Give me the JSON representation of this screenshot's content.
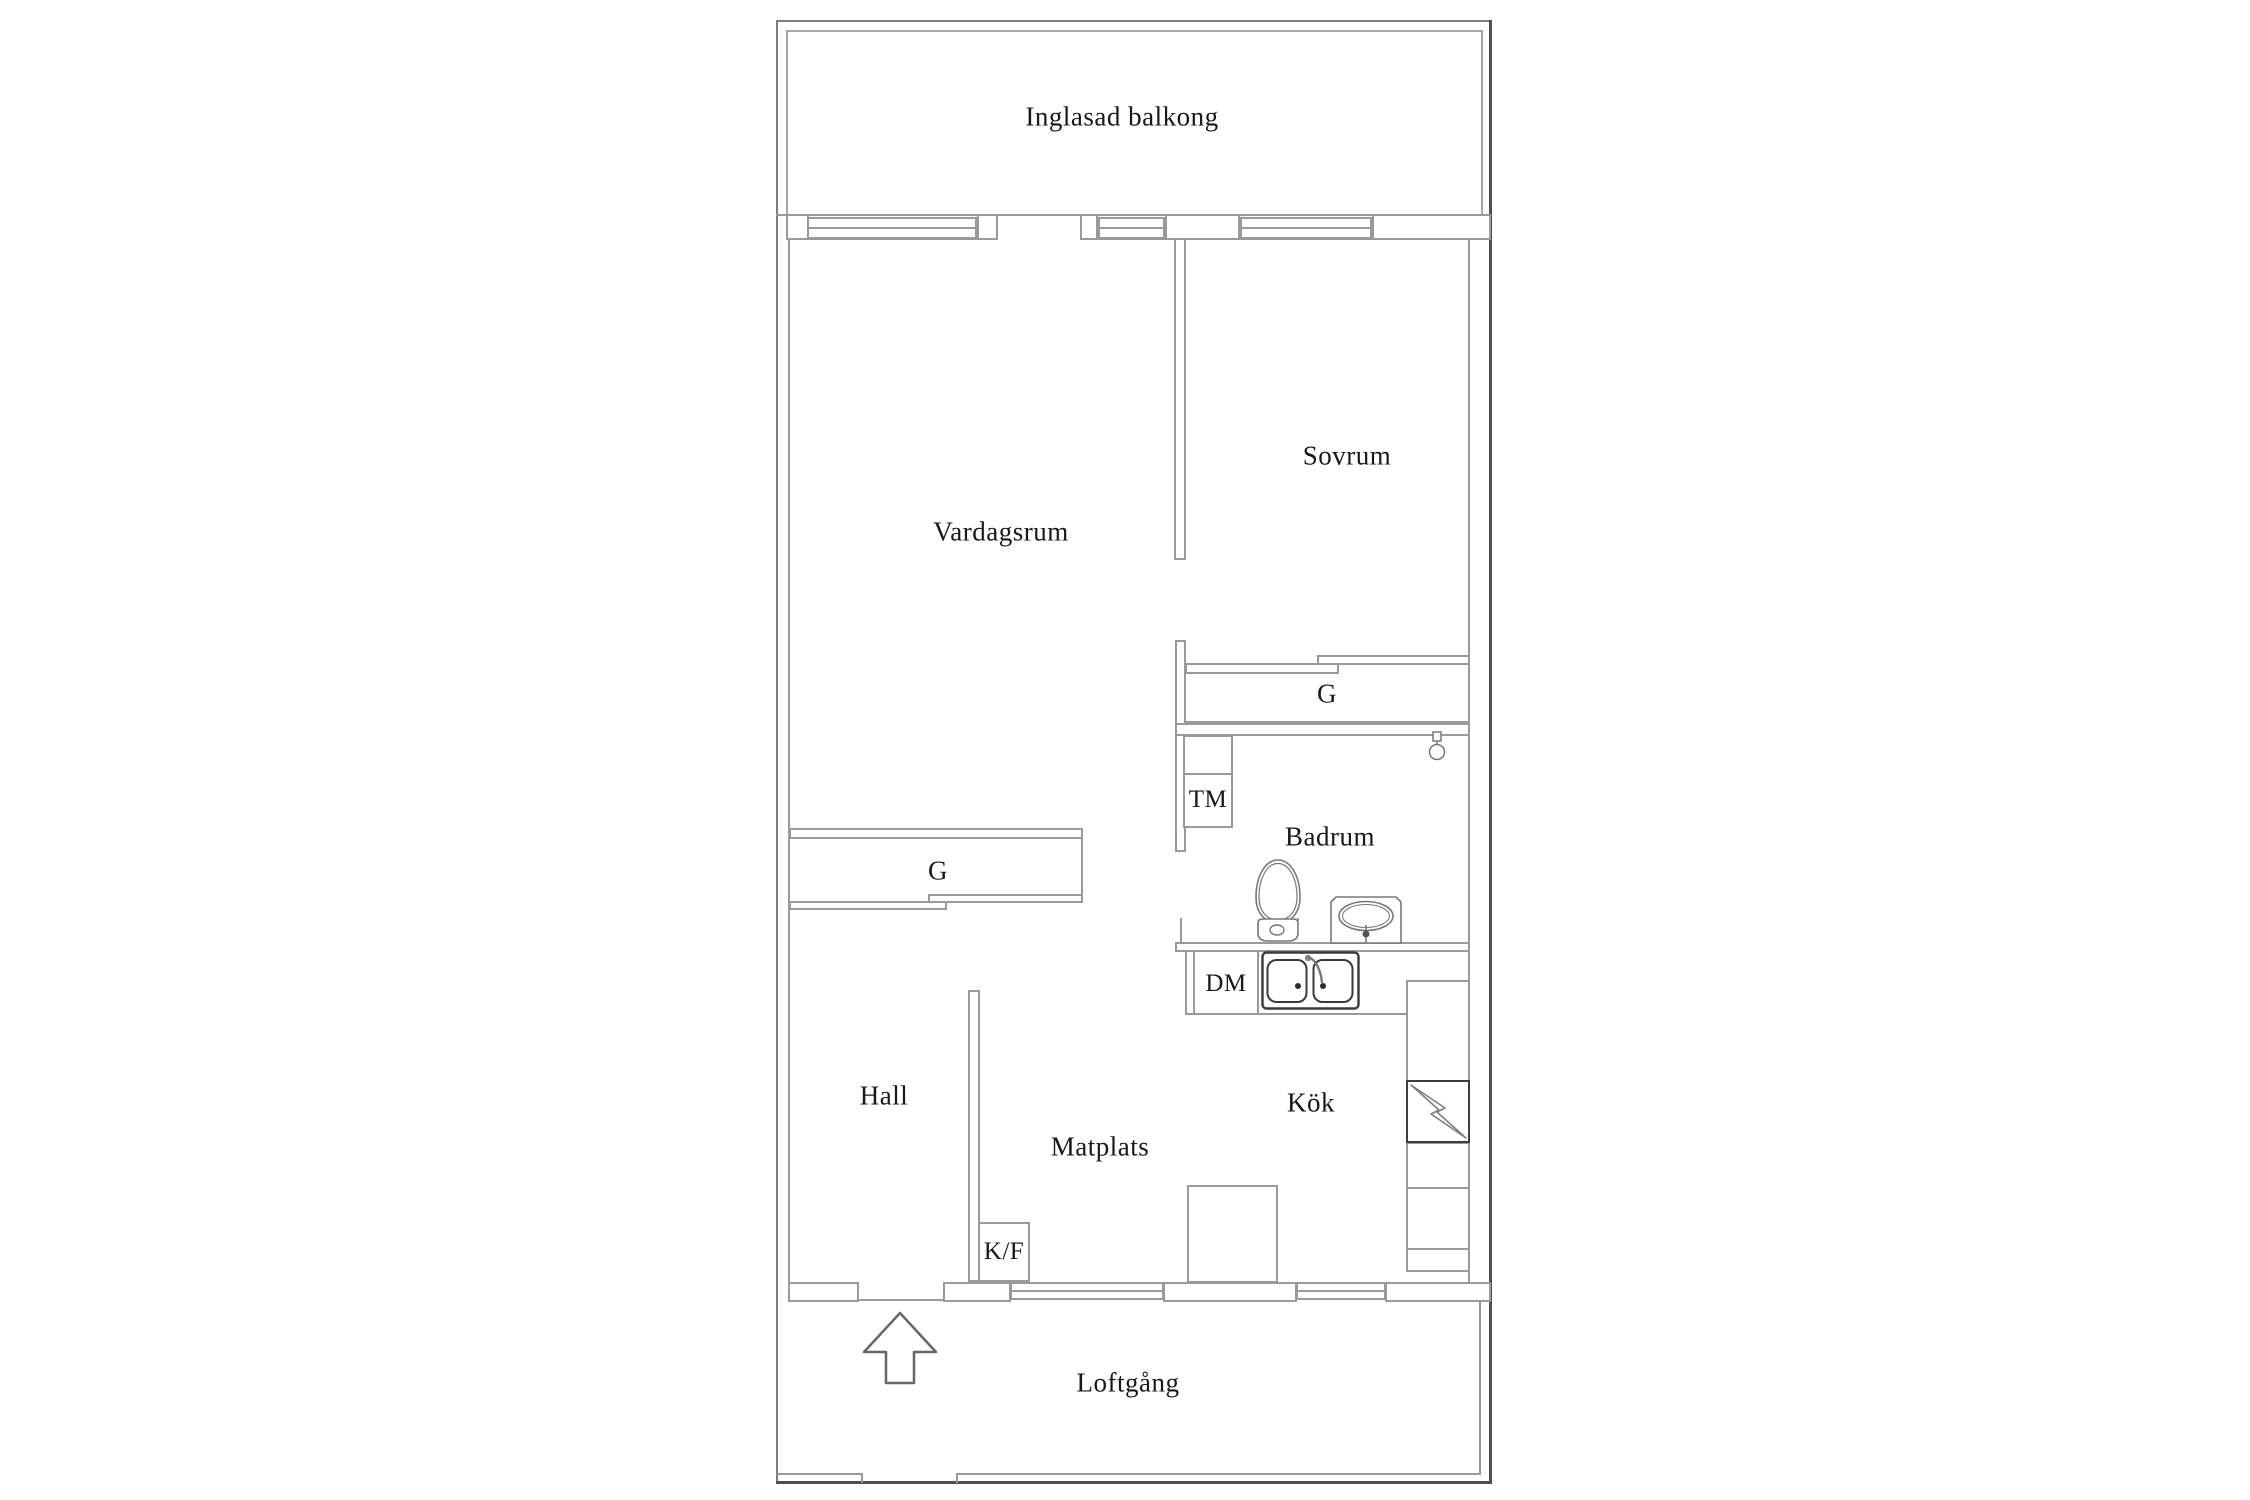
{
  "document": {
    "type": "apartment-floor-plan",
    "language": "Swedish"
  },
  "labels": {
    "balcony": "Inglasad balkong",
    "living_room": "Vardagsrum",
    "bedroom": "Sovrum",
    "bathroom": "Badrum",
    "hall": "Hall",
    "dining": "Matplats",
    "kitchen": "Kök",
    "walkway": "Loftgång",
    "wardrobe_bedroom": "G",
    "wardrobe_hall": "G",
    "washing_machine": "TM",
    "dishwasher": "DM",
    "fridge_freezer": "K/F"
  },
  "icons": {
    "toilet": "toilet-icon",
    "bathroom_sink": "bathroom-sink-icon",
    "kitchen_sink": "kitchen-sink-icon",
    "electrical": "lightning-icon",
    "floor_drain": "floor-drain-icon",
    "entrance": "entrance-arrow-icon"
  },
  "colors": {
    "wall": "#9a9a9a",
    "wall_dark": "#4f4f4f",
    "fixture_outline": "#787878",
    "sink_outline": "#3a3a3a",
    "text": "#181818",
    "background": "#ffffff"
  }
}
